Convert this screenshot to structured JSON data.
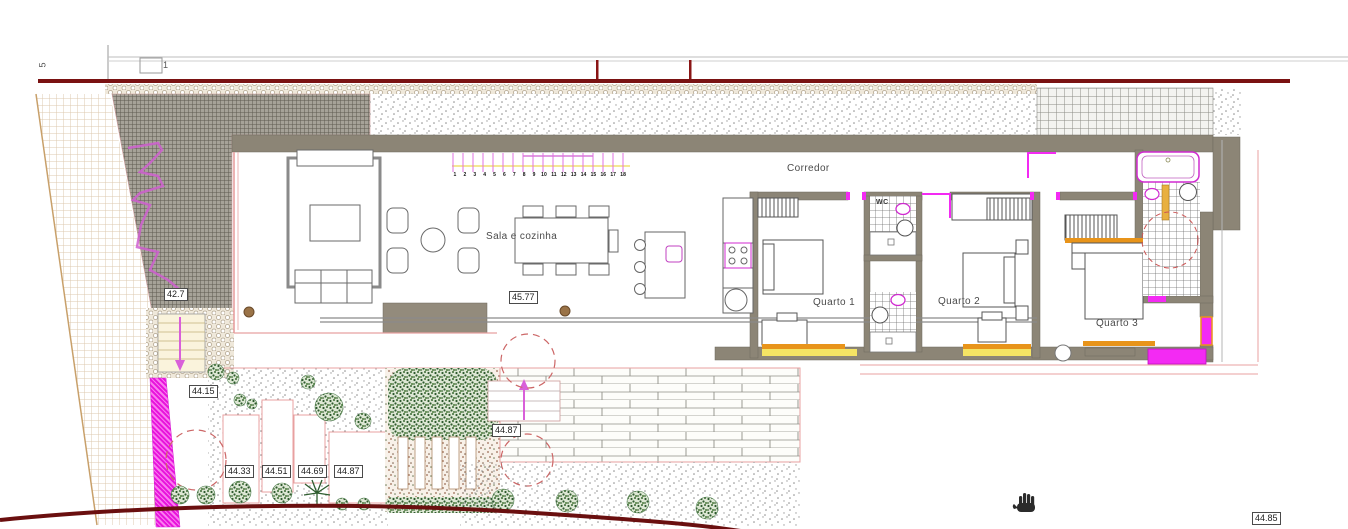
{
  "labels": {
    "corridor": "Corredor",
    "living": "Sala e cozinha",
    "bedroom1": "Quarto 1",
    "bedroom2": "Quarto 2",
    "bedroom3": "Quarto 3",
    "wc": "WC"
  },
  "elevations": {
    "ramp": "42.7",
    "living_floor": "45.77",
    "entry_landing": "44.15",
    "terrace_bed_1": "44.33",
    "terrace_bed_2": "44.51",
    "terrace_bed_3": "44.69",
    "terrace_bed_4": "44.87",
    "deck": "44.87",
    "edge_clipped": "44.85"
  },
  "frame_marks": {
    "left": "5",
    "detail": "1"
  },
  "stair_numbers": [
    "1",
    "2",
    "3",
    "4",
    "5",
    "6",
    "7",
    "8",
    "9",
    "10",
    "11",
    "12",
    "13",
    "14",
    "15",
    "16",
    "17",
    "18"
  ],
  "cursor": {
    "type": "hand-pan"
  },
  "colors": {
    "boundary_red": "#7a1212",
    "magenta": "#ee22ee",
    "wall_gray": "#8c8576",
    "sill_orange": "#e8941a",
    "window_yellow": "#f5e464",
    "plan_pink": "#e8a0a0"
  }
}
